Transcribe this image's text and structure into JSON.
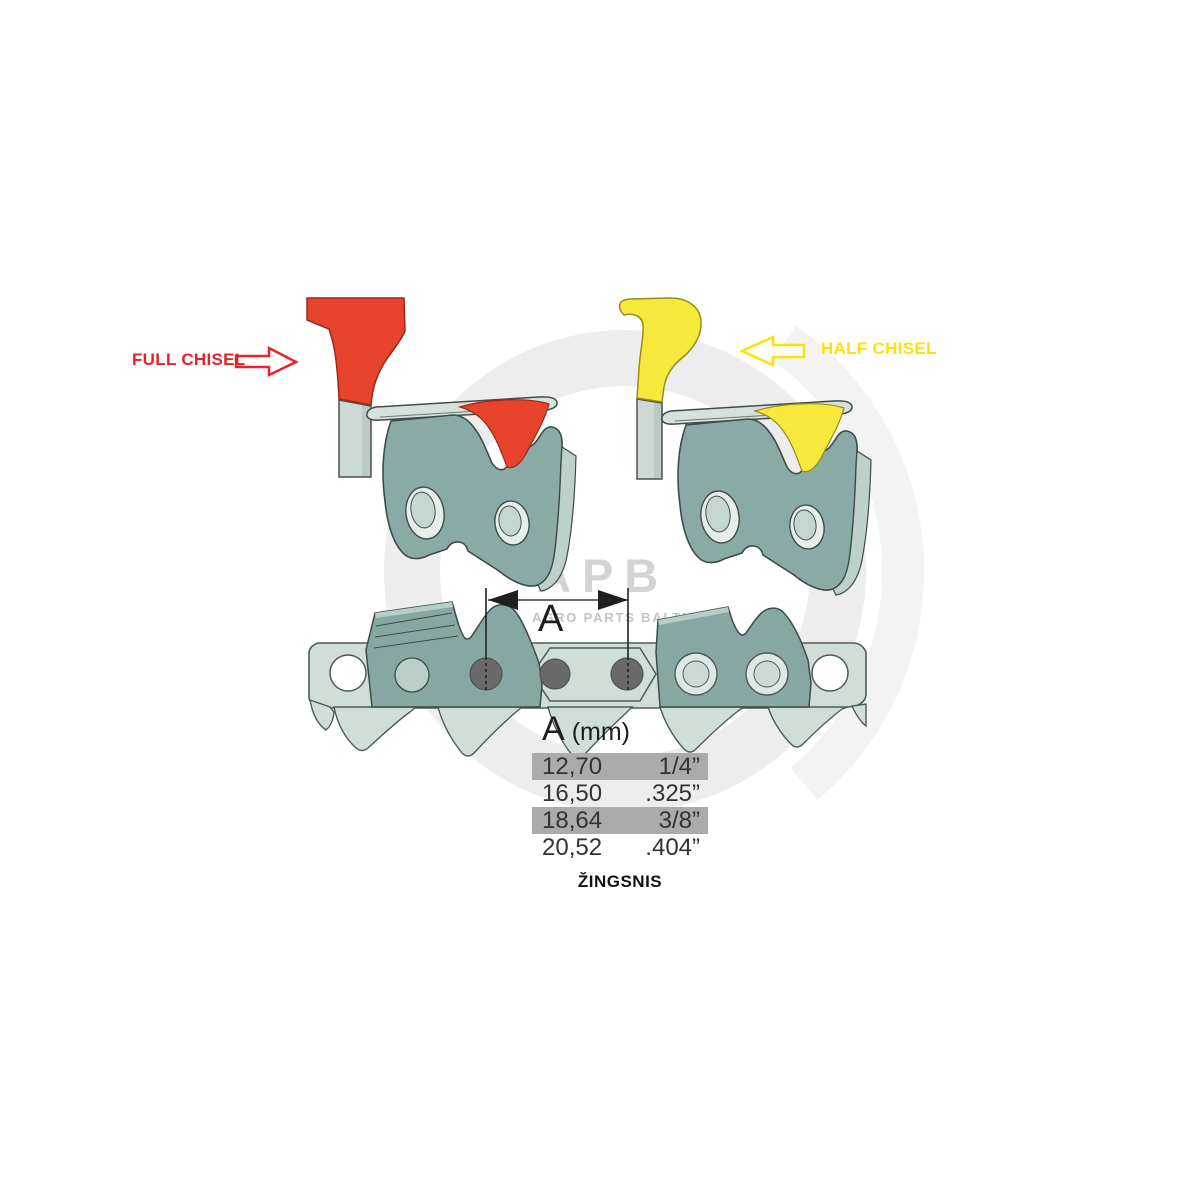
{
  "labels": {
    "full_chisel": "FULL CHISEL",
    "half_chisel": "HALF CHISEL",
    "dimension": "A",
    "pitch_caption": "ŽINGSNIS"
  },
  "watermark": {
    "logo": "APB",
    "subtitle": "AGRO PARTS BALTIJA"
  },
  "pitch_table": {
    "header": {
      "dim": "A",
      "unit": "(mm)"
    },
    "rows": [
      {
        "mm": "12,70",
        "inch": "1/4”",
        "highlighted": true
      },
      {
        "mm": "16,50",
        "inch": ".325”",
        "highlighted": false
      },
      {
        "mm": "18,64",
        "inch": "3/8”",
        "highlighted": true
      },
      {
        "mm": "20,52",
        "inch": ".404”",
        "highlighted": false
      }
    ]
  },
  "colors": {
    "full_chisel_accent": "#e8432b",
    "full_chisel_text": "#e62129",
    "half_chisel_accent": "#f6e93b",
    "half_chisel_text": "#ffe10a",
    "cutter_body": "#8aaba5",
    "strap": "#cfdfd8",
    "rivet": "#6a6a6a",
    "table_highlight": "#ababab",
    "watermark_gray": "#c9c9c9"
  }
}
